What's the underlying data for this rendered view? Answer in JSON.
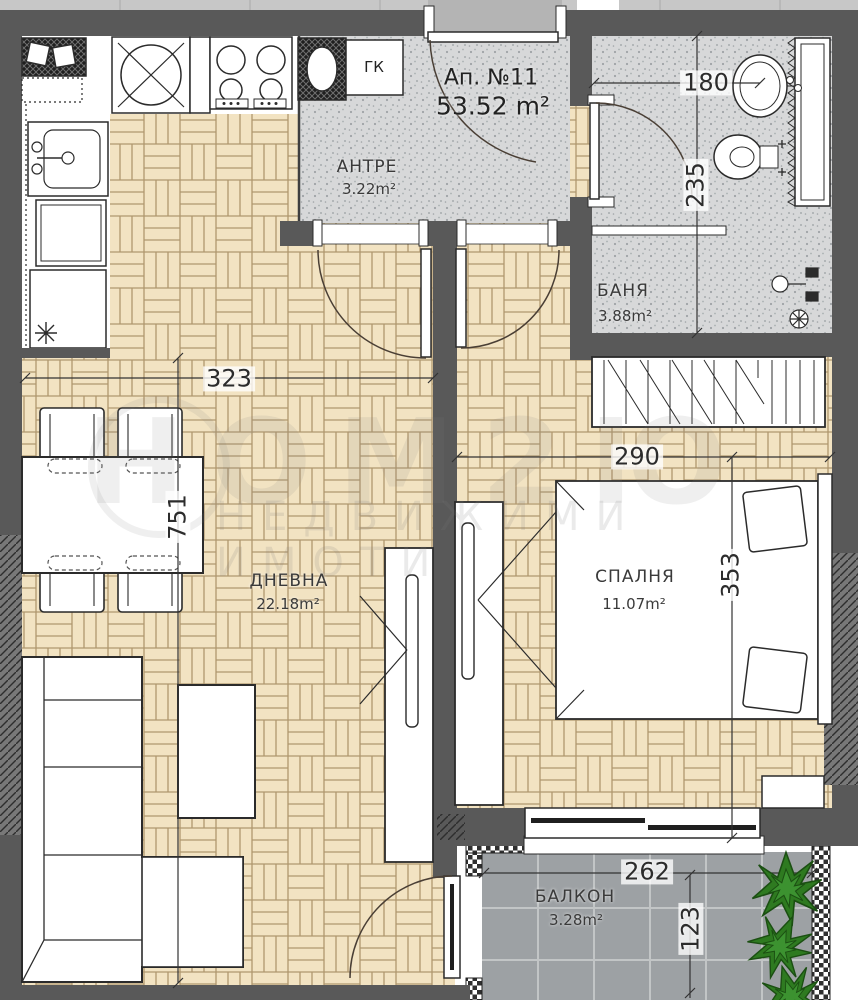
{
  "title": {
    "apartment": "Ап. №11",
    "total_area": "53.52 m²"
  },
  "rooms": {
    "antre": {
      "name": "АНТРЕ",
      "area": "3.22m²"
    },
    "banya": {
      "name": "БАНЯ",
      "area": "3.88m²"
    },
    "dnevna": {
      "name": "ДНЕВНА",
      "area": "22.18m²"
    },
    "spalnya": {
      "name": "СПАЛНЯ",
      "area": "11.07m²"
    },
    "balkon": {
      "name": "БАЛКОН",
      "area": "3.28m²"
    }
  },
  "labels": {
    "closet": "ГК"
  },
  "dimensions": {
    "living_width": "323",
    "living_length": "751",
    "bedroom_width": "290",
    "bedroom_length": "353",
    "bath_width": "180",
    "bath_length": "235",
    "balcony_width": "262",
    "balcony_depth": "123"
  },
  "watermark": {
    "brand": "НОМ2Ю",
    "tagline": "НЕДВИЖИМИ ИМОТИ"
  },
  "colors": {
    "wall": "#595959",
    "parquet": "#f2e3c2",
    "parquet_line": "#b0976e",
    "stipple_floor": "#d7d8d9",
    "balcony_floor": "#9da1a4",
    "plant_green": "#2e7a20",
    "outline": "#2b2b2b"
  }
}
